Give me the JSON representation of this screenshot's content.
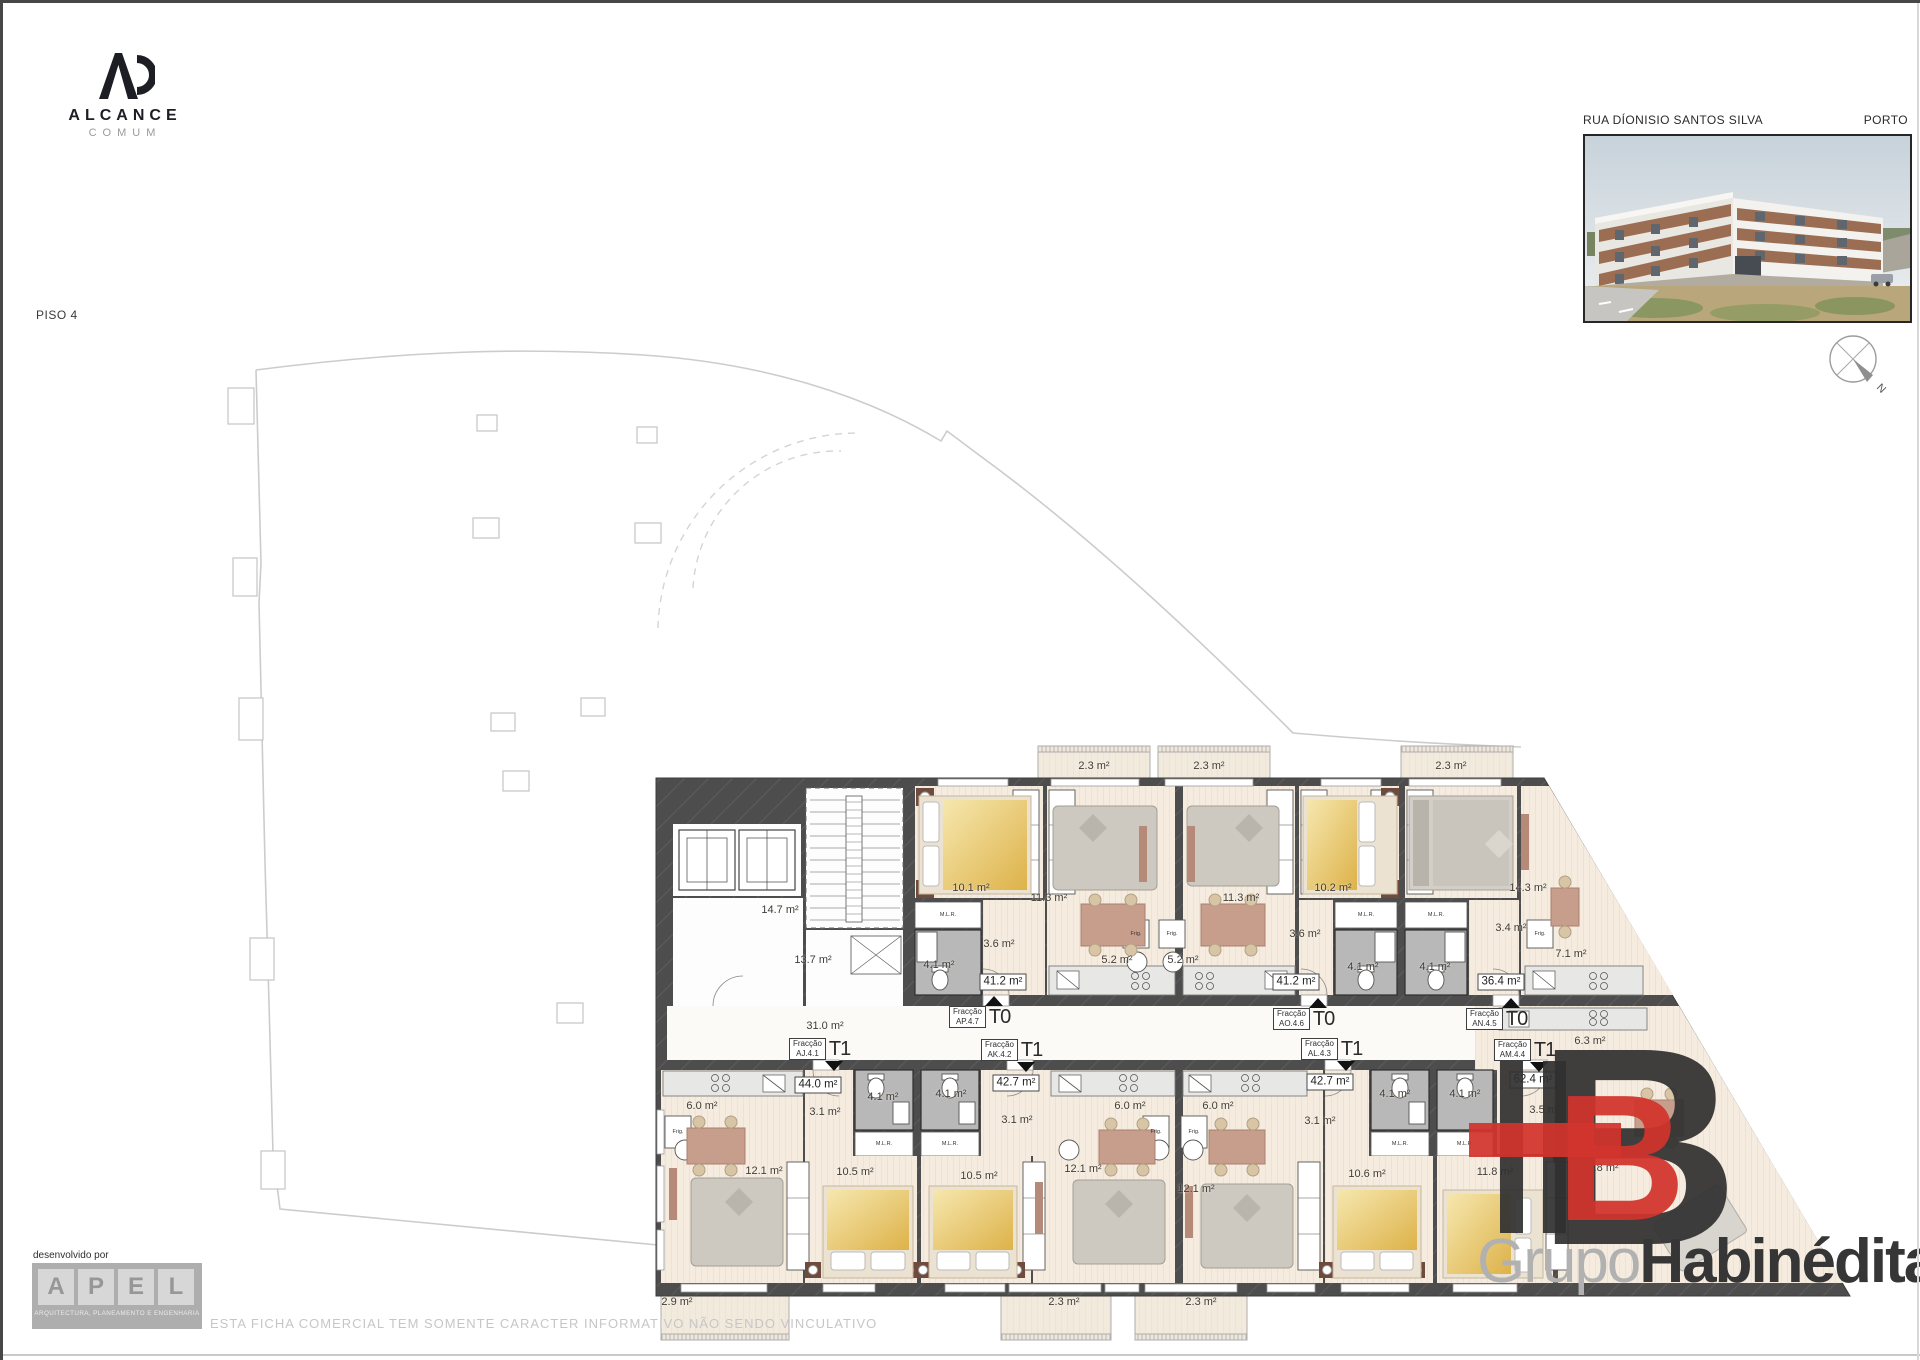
{
  "page": {
    "floor_label": "PISO 4",
    "disclaimer": "ESTA FICHA COMERCIAL TEM SOMENTE CARACTER INFORMATIVO NÃO SENDO VINCULATIVO"
  },
  "header": {
    "street": "RUA DÍONISIO SANTOS SILVA",
    "city": "PORTO"
  },
  "branding": {
    "alcance": {
      "name": "ALCANCE",
      "subtitle": "COMUM"
    },
    "developed_by": "desenvolvido por",
    "adel": {
      "letters": [
        "A",
        "P",
        "E",
        "L"
      ],
      "caption": "ARQUITECTURA, PLANEAMENTO E ENGENHARIA"
    },
    "habinedita": {
      "monogram_letter": "B",
      "grupo": "Grupo",
      "name": "Habinédita",
      "registered": "®",
      "red": "#d2342c",
      "dark": "#343434"
    }
  },
  "compass": {
    "label": "N"
  },
  "plan": {
    "wall_color": "#4d4d4d",
    "floor_color": "#f5ecdf",
    "fraction_word": "Fracção",
    "units": [
      {
        "fraction": "AP.4.7",
        "type": "T0",
        "total_area": "41.2 m²"
      },
      {
        "fraction": "AO.4.6",
        "type": "T0",
        "total_area": "41.2 m²"
      },
      {
        "fraction": "AN.4.5",
        "type": "T0",
        "total_area": "36.4 m²"
      },
      {
        "fraction": "AJ.4.1",
        "type": "T1",
        "total_area": "44.0 m²"
      },
      {
        "fraction": "AK.4.2",
        "type": "T1",
        "total_area": "42.7 m²"
      },
      {
        "fraction": "AL.4.3",
        "type": "T1",
        "total_area": "42.7 m²"
      },
      {
        "fraction": "AM.4.4",
        "type": "T1",
        "total_area": "62.4 m²"
      }
    ],
    "fraction_tags": [
      {
        "code": "AP.4.7",
        "type": "T0",
        "x": 296,
        "y": 268,
        "dir": "up"
      },
      {
        "code": "AO.4.6",
        "type": "T0",
        "x": 620,
        "y": 270,
        "dir": "up"
      },
      {
        "code": "AN.4.5",
        "type": "T0",
        "x": 813,
        "y": 270,
        "dir": "up"
      },
      {
        "code": "AJ.4.1",
        "type": "T1",
        "x": 136,
        "y": 300,
        "dir": "down"
      },
      {
        "code": "AK.4.2",
        "type": "T1",
        "x": 328,
        "y": 301,
        "dir": "down"
      },
      {
        "code": "AL.4.3",
        "type": "T1",
        "x": 648,
        "y": 300,
        "dir": "down"
      },
      {
        "code": "AM.4.4",
        "type": "T1",
        "x": 841,
        "y": 301,
        "dir": "down"
      }
    ],
    "area_labels": [
      {
        "t": "2.3 m²",
        "x": 441,
        "y": 28
      },
      {
        "t": "2.3 m²",
        "x": 556,
        "y": 28
      },
      {
        "t": "2.3 m²",
        "x": 798,
        "y": 28
      },
      {
        "t": "10.1 m²",
        "x": 318,
        "y": 150
      },
      {
        "t": "11.3 m²",
        "x": 396,
        "y": 160
      },
      {
        "t": "11.3 m²",
        "x": 588,
        "y": 160
      },
      {
        "t": "10.2 m²",
        "x": 680,
        "y": 150
      },
      {
        "t": "14.3 m²",
        "x": 875,
        "y": 150
      },
      {
        "t": "3.6 m²",
        "x": 346,
        "y": 206
      },
      {
        "t": "3.6 m²",
        "x": 652,
        "y": 196
      },
      {
        "t": "3.4 m²",
        "x": 858,
        "y": 190
      },
      {
        "t": "4.1 m²",
        "x": 286,
        "y": 227
      },
      {
        "t": "4.1 m²",
        "x": 710,
        "y": 229
      },
      {
        "t": "4.1 m²",
        "x": 782,
        "y": 229
      },
      {
        "t": "5.2 m²",
        "x": 464,
        "y": 222
      },
      {
        "t": "5.2 m²",
        "x": 530,
        "y": 222
      },
      {
        "t": "7.1 m²",
        "x": 918,
        "y": 216
      },
      {
        "t": "41.2 m²",
        "x": 350,
        "y": 244,
        "b": 1
      },
      {
        "t": "41.2 m²",
        "x": 643,
        "y": 244,
        "b": 1
      },
      {
        "t": "36.4 m²",
        "x": 848,
        "y": 244,
        "b": 1
      },
      {
        "t": "14.7 m²",
        "x": 127,
        "y": 172
      },
      {
        "t": "13.7 m²",
        "x": 160,
        "y": 222
      },
      {
        "t": "31.0 m²",
        "x": 172,
        "y": 288
      },
      {
        "t": "44.0 m²",
        "x": 165,
        "y": 347,
        "b": 1
      },
      {
        "t": "42.7 m²",
        "x": 363,
        "y": 345,
        "b": 1
      },
      {
        "t": "42.7 m²",
        "x": 677,
        "y": 344,
        "b": 1
      },
      {
        "t": "62.4 m²",
        "x": 880,
        "y": 342,
        "b": 1
      },
      {
        "t": "6.0 m²",
        "x": 49,
        "y": 368
      },
      {
        "t": "3.1 m²",
        "x": 172,
        "y": 374
      },
      {
        "t": "4.1 m²",
        "x": 230,
        "y": 359
      },
      {
        "t": "4.1 m²",
        "x": 298,
        "y": 356
      },
      {
        "t": "3.1 m²",
        "x": 364,
        "y": 382
      },
      {
        "t": "12.1 m²",
        "x": 111,
        "y": 433
      },
      {
        "t": "10.5 m²",
        "x": 202,
        "y": 434
      },
      {
        "t": "10.5 m²",
        "x": 326,
        "y": 438
      },
      {
        "t": "12.1 m²",
        "x": 430,
        "y": 431
      },
      {
        "t": "6.0 m²",
        "x": 477,
        "y": 368
      },
      {
        "t": "6.0 m²",
        "x": 565,
        "y": 368
      },
      {
        "t": "12.1 m²",
        "x": 543,
        "y": 451
      },
      {
        "t": "3.1 m²",
        "x": 667,
        "y": 383
      },
      {
        "t": "4.1 m²",
        "x": 742,
        "y": 356
      },
      {
        "t": "4.1 m²",
        "x": 812,
        "y": 356
      },
      {
        "t": "10.6 m²",
        "x": 714,
        "y": 436
      },
      {
        "t": "6.3 m²",
        "x": 937,
        "y": 303
      },
      {
        "t": "3.5 m²",
        "x": 892,
        "y": 372
      },
      {
        "t": "11.8 m²",
        "x": 842,
        "y": 434
      },
      {
        "t": "25.8 m²",
        "x": 947,
        "y": 430
      },
      {
        "t": "2.9 m²",
        "x": 24,
        "y": 564
      },
      {
        "t": "2.3 m²",
        "x": 411,
        "y": 564
      },
      {
        "t": "2.3 m²",
        "x": 548,
        "y": 564
      }
    ],
    "fixture_labels": [
      {
        "t": "M.L.R.",
        "x": 295,
        "y": 177
      },
      {
        "t": "M.L.R.",
        "x": 713,
        "y": 177
      },
      {
        "t": "M.L.R.",
        "x": 783,
        "y": 177
      },
      {
        "t": "Frig.",
        "x": 483,
        "y": 196
      },
      {
        "t": "Frig.",
        "x": 519,
        "y": 196
      },
      {
        "t": "Frig.",
        "x": 887,
        "y": 196
      },
      {
        "t": "Frig.",
        "x": 25,
        "y": 394
      },
      {
        "t": "Frig.",
        "x": 503,
        "y": 394
      },
      {
        "t": "Frig.",
        "x": 541,
        "y": 394
      },
      {
        "t": "M.L.R.",
        "x": 231,
        "y": 406
      },
      {
        "t": "M.L.R.",
        "x": 297,
        "y": 406
      },
      {
        "t": "M.L.R.",
        "x": 747,
        "y": 406
      },
      {
        "t": "M.L.R.",
        "x": 812,
        "y": 406
      }
    ]
  }
}
